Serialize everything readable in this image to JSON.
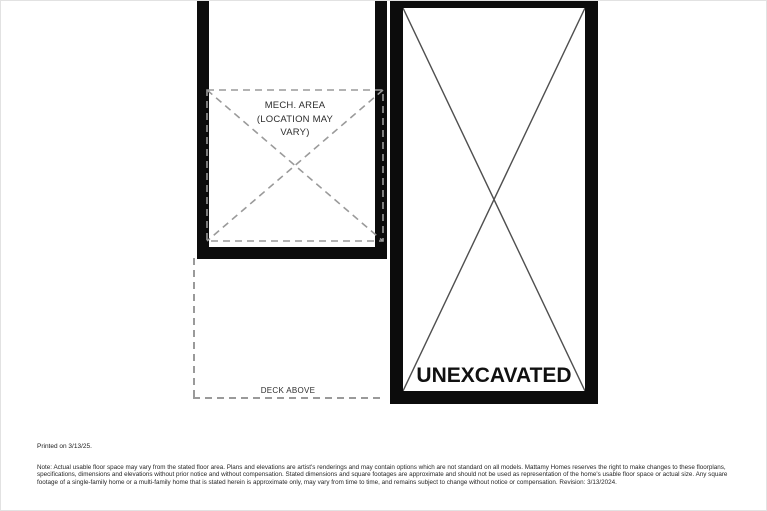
{
  "plan": {
    "mech_area_label": [
      "MECH. AREA",
      "(LOCATION MAY",
      "VARY)"
    ],
    "deck_label": "DECK ABOVE",
    "unexcavated_label": "UNEXCAVATED"
  },
  "footer": {
    "printed_on": "Printed on 3/13/25.",
    "disclaimer": "Note: Actual usable floor space may vary from the stated floor area. Plans and elevations are artist's renderings and may contain options which are not standard on all models. Mattamy Homes reserves the right to make changes to these floorplans, specifications, dimensions and elevations without prior notice and without compensation. Stated dimensions and square footages are approximate and should not be used as representation of the home's usable floor space or actual size. Any square footage of a single-family home or a multi-family home that is stated herein is approximate only, may vary from time to time, and remains subject to change without notice or compensation. Revision: 3/13/2024."
  },
  "colors": {
    "wall": "#0c0c0c",
    "dashed_line": "#9a9a9a",
    "diagonal": "#4f4f4f",
    "label_text": "#2e2e2e"
  }
}
